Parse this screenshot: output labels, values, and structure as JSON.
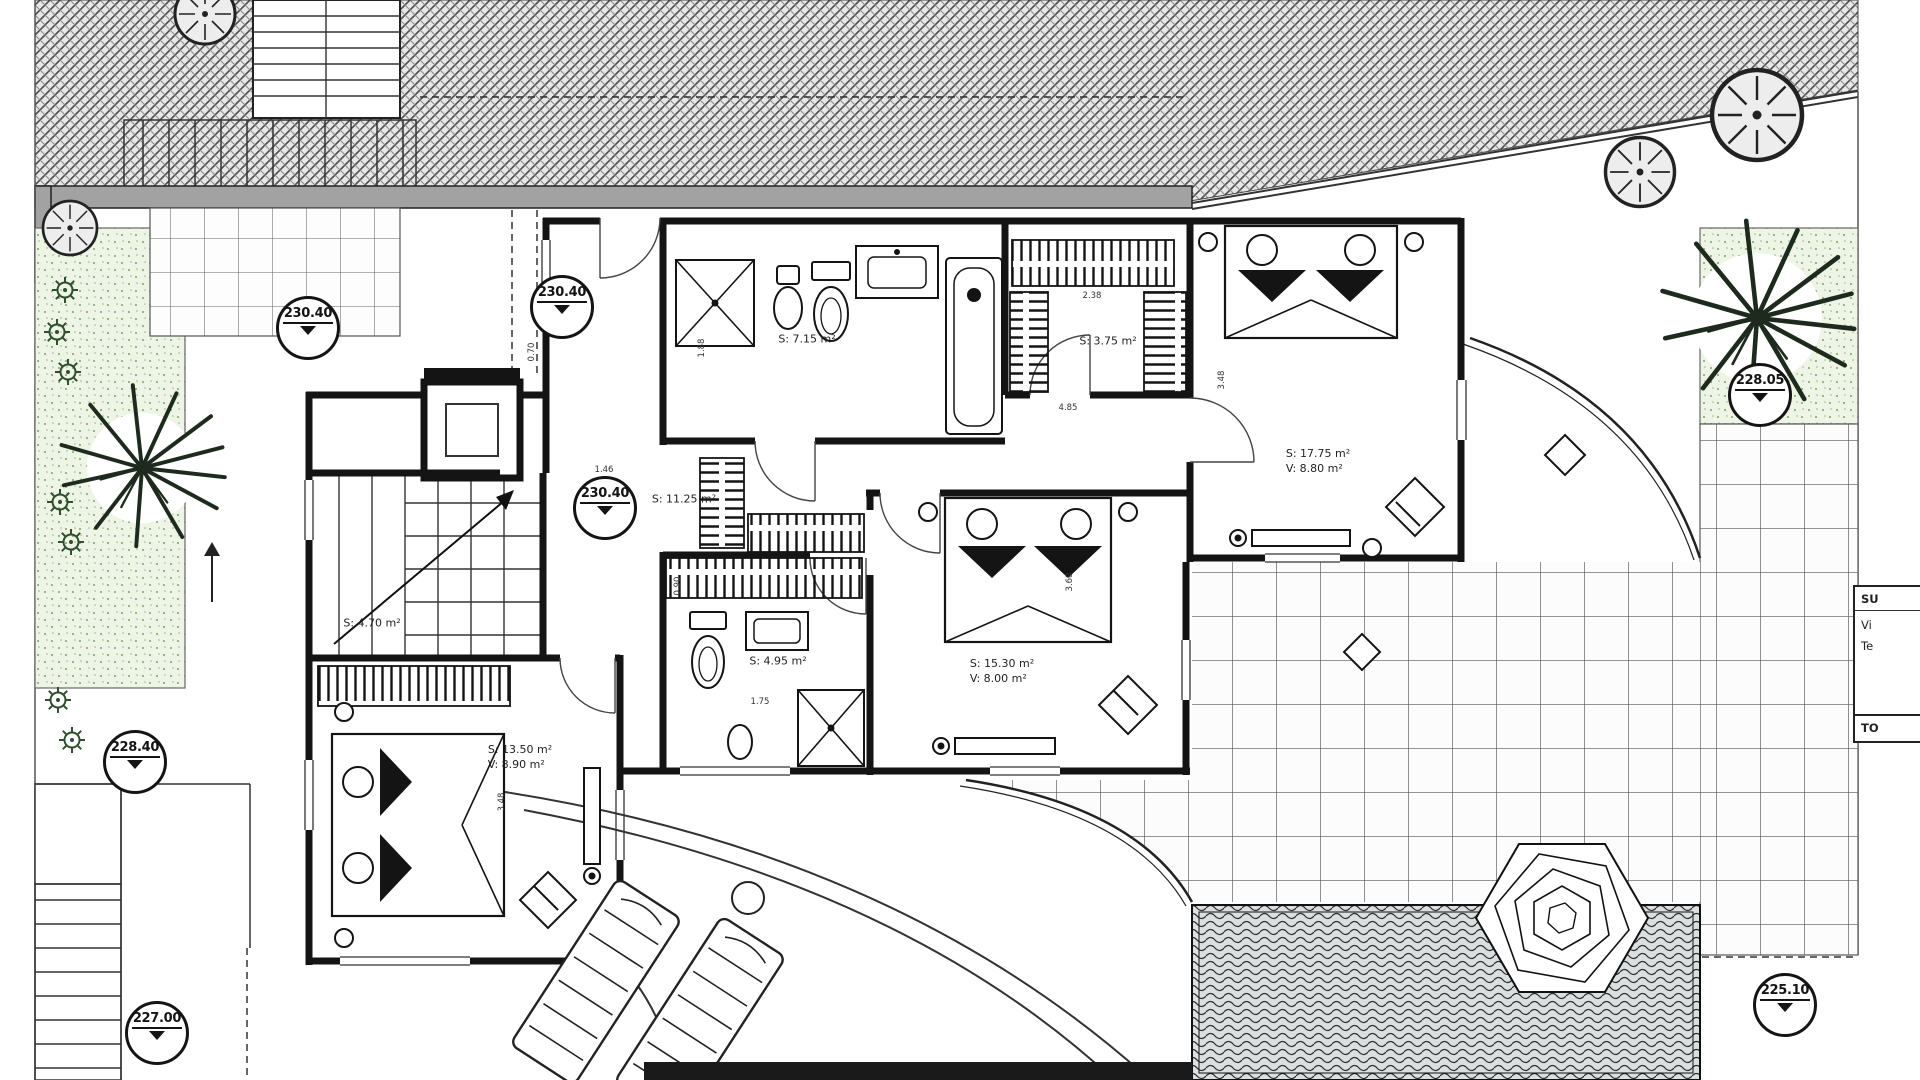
{
  "colors": {
    "line": "#1a1a1a",
    "retaining_wall": "#a2a2a2",
    "hatch_bg": "#e7e7e7",
    "garden_bg": "#eef4e6",
    "garden_dot": "#7da263",
    "water_bg": "#dcdfe0"
  },
  "elevation_markers": [
    {
      "value": "230.40",
      "x": 308,
      "y": 328
    },
    {
      "value": "230.40",
      "x": 562,
      "y": 307
    },
    {
      "value": "230.40",
      "x": 605,
      "y": 508
    },
    {
      "value": "228.40",
      "x": 135,
      "y": 762
    },
    {
      "value": "228.05",
      "x": 1760,
      "y": 395
    },
    {
      "value": "227.00",
      "x": 157,
      "y": 1033
    },
    {
      "value": "225.10",
      "x": 1785,
      "y": 1005
    }
  ],
  "room_labels": [
    {
      "area": "S: 7.15 m²",
      "volume": "",
      "x": 807,
      "y": 340
    },
    {
      "area": "S: 3.75 m²",
      "volume": "",
      "x": 1108,
      "y": 342
    },
    {
      "area": "S: 17.75 m²",
      "volume": "V: 8.80 m²",
      "x": 1318,
      "y": 462
    },
    {
      "area": "S: 11.25 m²",
      "volume": "",
      "x": 684,
      "y": 500
    },
    {
      "area": "S: 4.95 m²",
      "volume": "",
      "x": 778,
      "y": 662
    },
    {
      "area": "S: 15.30 m²",
      "volume": "V: 8.00 m²",
      "x": 1002,
      "y": 672
    },
    {
      "area": "S: 13.50 m²",
      "volume": "V: 8.90 m²",
      "x": 520,
      "y": 758
    },
    {
      "area": "S: 4.70 m²",
      "volume": "",
      "x": 372,
      "y": 624
    }
  ],
  "dimension_labels": [
    {
      "value": "2.38",
      "x": 1092,
      "y": 296,
      "vertical": false
    },
    {
      "value": "4.85",
      "x": 1068,
      "y": 408,
      "vertical": false
    },
    {
      "value": "3.48",
      "x": 1222,
      "y": 380,
      "vertical": true
    },
    {
      "value": "1.88",
      "x": 702,
      "y": 348,
      "vertical": true
    },
    {
      "value": "0.70",
      "x": 532,
      "y": 352,
      "vertical": true
    },
    {
      "value": "1.46",
      "x": 604,
      "y": 470,
      "vertical": false
    },
    {
      "value": "1.75",
      "x": 760,
      "y": 702,
      "vertical": false
    },
    {
      "value": "3.68",
      "x": 1070,
      "y": 582,
      "vertical": true
    },
    {
      "value": "3.48",
      "x": 502,
      "y": 802,
      "vertical": true
    },
    {
      "value": "0.90",
      "x": 678,
      "y": 586,
      "vertical": true
    }
  ],
  "legend_table": {
    "header": "SU",
    "rows": [
      "Vi",
      "Te"
    ],
    "total": "TO"
  }
}
